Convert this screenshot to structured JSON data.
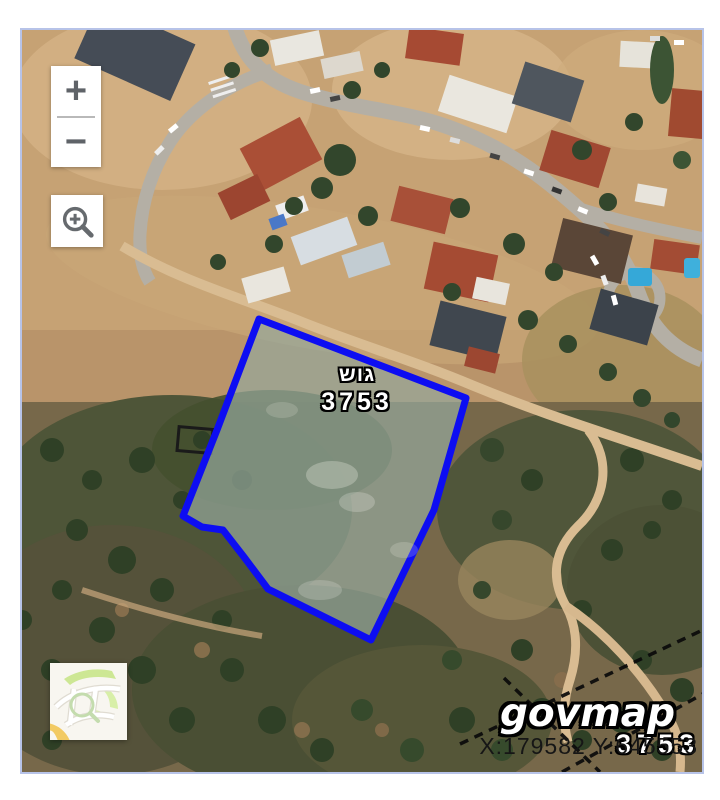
{
  "window": {
    "background_color": "#ffffff",
    "map_border_color": "#b7c3e8"
  },
  "map": {
    "type": "aerial-satellite",
    "controls": {
      "zoom_in_label": "+",
      "zoom_out_label": "−",
      "zoom_area_tool": "magnifier-plus",
      "overview_toggle": "street-map-thumbnail"
    },
    "parcel": {
      "label_type": "גוש",
      "label_number": "3753",
      "stroke_color": "#0d0df2",
      "fill_color": "rgba(150,168,156,0.7)"
    },
    "edge_parcel_number": "3753",
    "branding": {
      "logo_text": "govmap"
    },
    "statusbar": {
      "coordinates": "X:179582 Y:645553"
    }
  }
}
